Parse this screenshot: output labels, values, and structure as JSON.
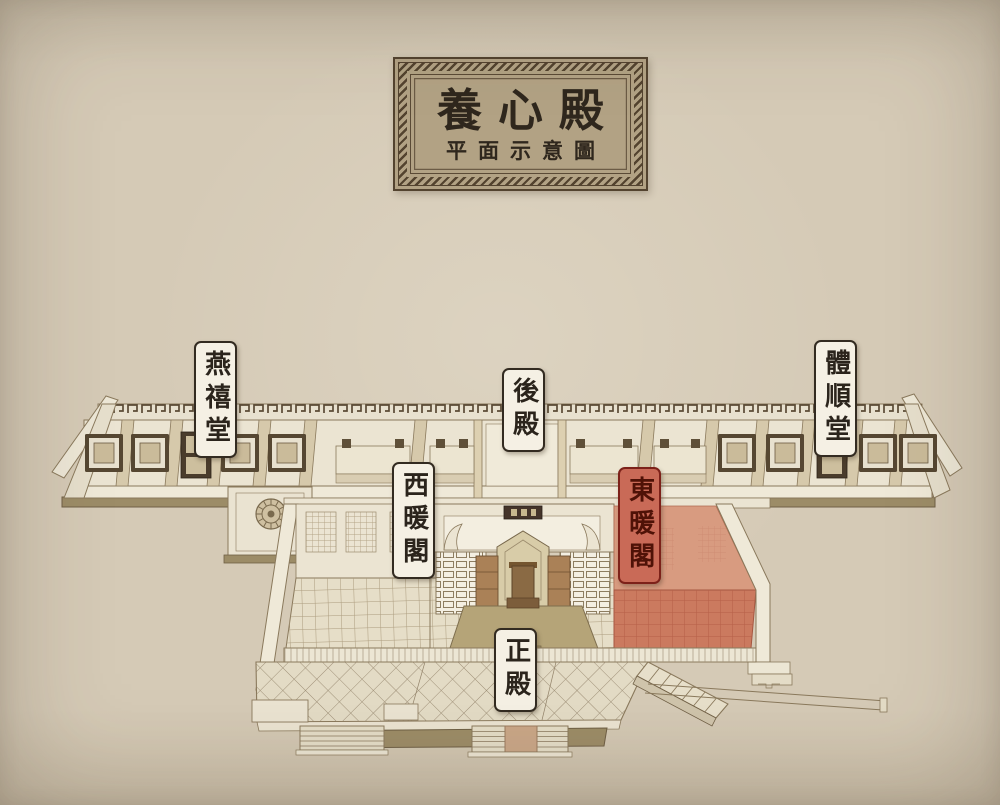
{
  "plaque": {
    "title": "養心殿",
    "subtitle": "平面示意圖"
  },
  "labels": {
    "yanxitang": "燕禧堂",
    "houdian": "後殿",
    "tishuntang": "體順堂",
    "xinuange": "西暖閣",
    "dongnuange": "東暖閣",
    "zhengdian": "正殿"
  },
  "highlight": {
    "highlighted_area": "東暖閣"
  },
  "colors": {
    "page_bg": "#d5cab6",
    "ink": "#8a795c",
    "dark_line": "#6f5f45",
    "wall": "#ece6d4",
    "floor": "#e6dec8",
    "olive": "#9c8c67",
    "panel_dark": "#564732",
    "highlight_floor": "#cb7a5f",
    "highlight_wall": "#d89b80",
    "highlight_grid": "#b65f47",
    "label_bg": "#f5f0e4",
    "label_border": "#332b21",
    "label_text": "#2b241c",
    "highlight_label_bg": "#c96a57",
    "highlight_label_border": "#7c2119",
    "highlight_label_text": "#4f1207",
    "plaque_bg": "#b2a284",
    "plaque_frame": "#53432f",
    "plaque_text": "#2f271d"
  }
}
